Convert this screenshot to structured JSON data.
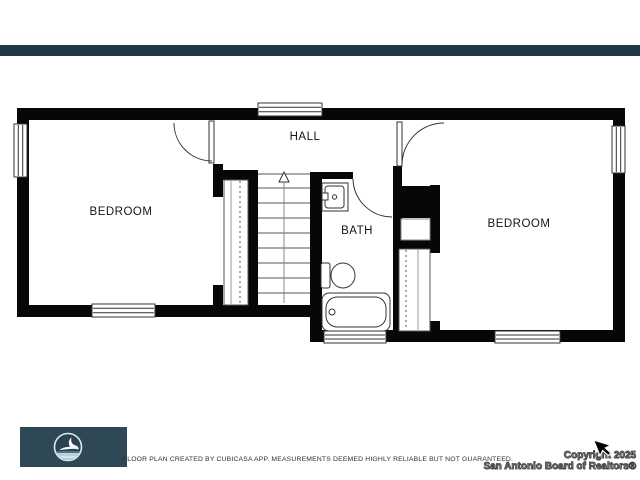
{
  "header": {
    "accent_bar_color": "#1e3945"
  },
  "floor_plan": {
    "rooms": {
      "hall": "HALL",
      "bedroom_left": "BEDROOM",
      "bath": "BATH",
      "bedroom_right": "BEDROOM"
    },
    "features": {
      "stairs": "stairs-up-arrow",
      "fixtures": [
        "sink-vanity",
        "toilet",
        "bathtub"
      ],
      "closets": [
        "sliding-door-closet-left",
        "sliding-door-closet-right"
      ],
      "windows_count": 6,
      "doors": [
        "bedroom-left-door",
        "bedroom-right-door",
        "bath-door"
      ]
    }
  },
  "footer": {
    "disclaimer": "FLOOR PLAN CREATED BY CUBICASA APP. MEASUREMENTS DEEMED HIGHLY RELIABLE BUT NOT GUARANTEED.",
    "copyright": {
      "line1": "Copyright 2025",
      "line2": "San Antonio Board of Realtors®"
    },
    "logo": {
      "icon": "flying-bird-logo",
      "bg_color": "#2e4955",
      "water_color": "#b9d3db",
      "ring_color": "#dfe9ec"
    }
  },
  "cursor": {
    "icon": "arrow-pointer"
  }
}
